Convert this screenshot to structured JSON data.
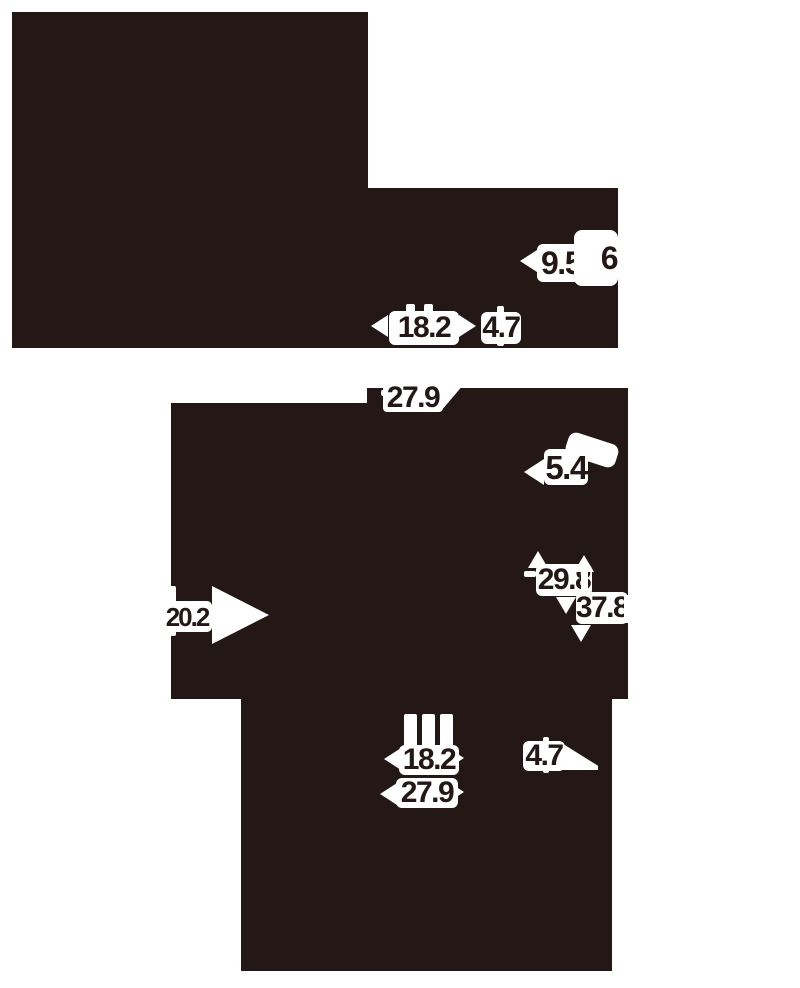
{
  "meta": {
    "kind": "product-dimension-diagram-silhouette",
    "ink_color": "#231815",
    "background_color": "#ffffff"
  },
  "callouts": [
    {
      "id": "top-view-side-height",
      "value": "9.5"
    },
    {
      "id": "top-view-edge",
      "value": "6"
    },
    {
      "id": "top-view-width",
      "value": "18.2"
    },
    {
      "id": "top-view-offset",
      "value": "4.7"
    },
    {
      "id": "front-view-depth",
      "value": "27.9"
    },
    {
      "id": "front-view-offset",
      "value": "5.4"
    },
    {
      "id": "front-view-inner-height",
      "value": "29.8"
    },
    {
      "id": "front-view-overall-height",
      "value": "37.8"
    },
    {
      "id": "front-view-left-depth",
      "value": "20.2"
    },
    {
      "id": "bottom-view-width",
      "value": "18.2"
    },
    {
      "id": "bottom-view-offset",
      "value": "4.7"
    },
    {
      "id": "bottom-view-depth",
      "value": "27.9"
    }
  ]
}
